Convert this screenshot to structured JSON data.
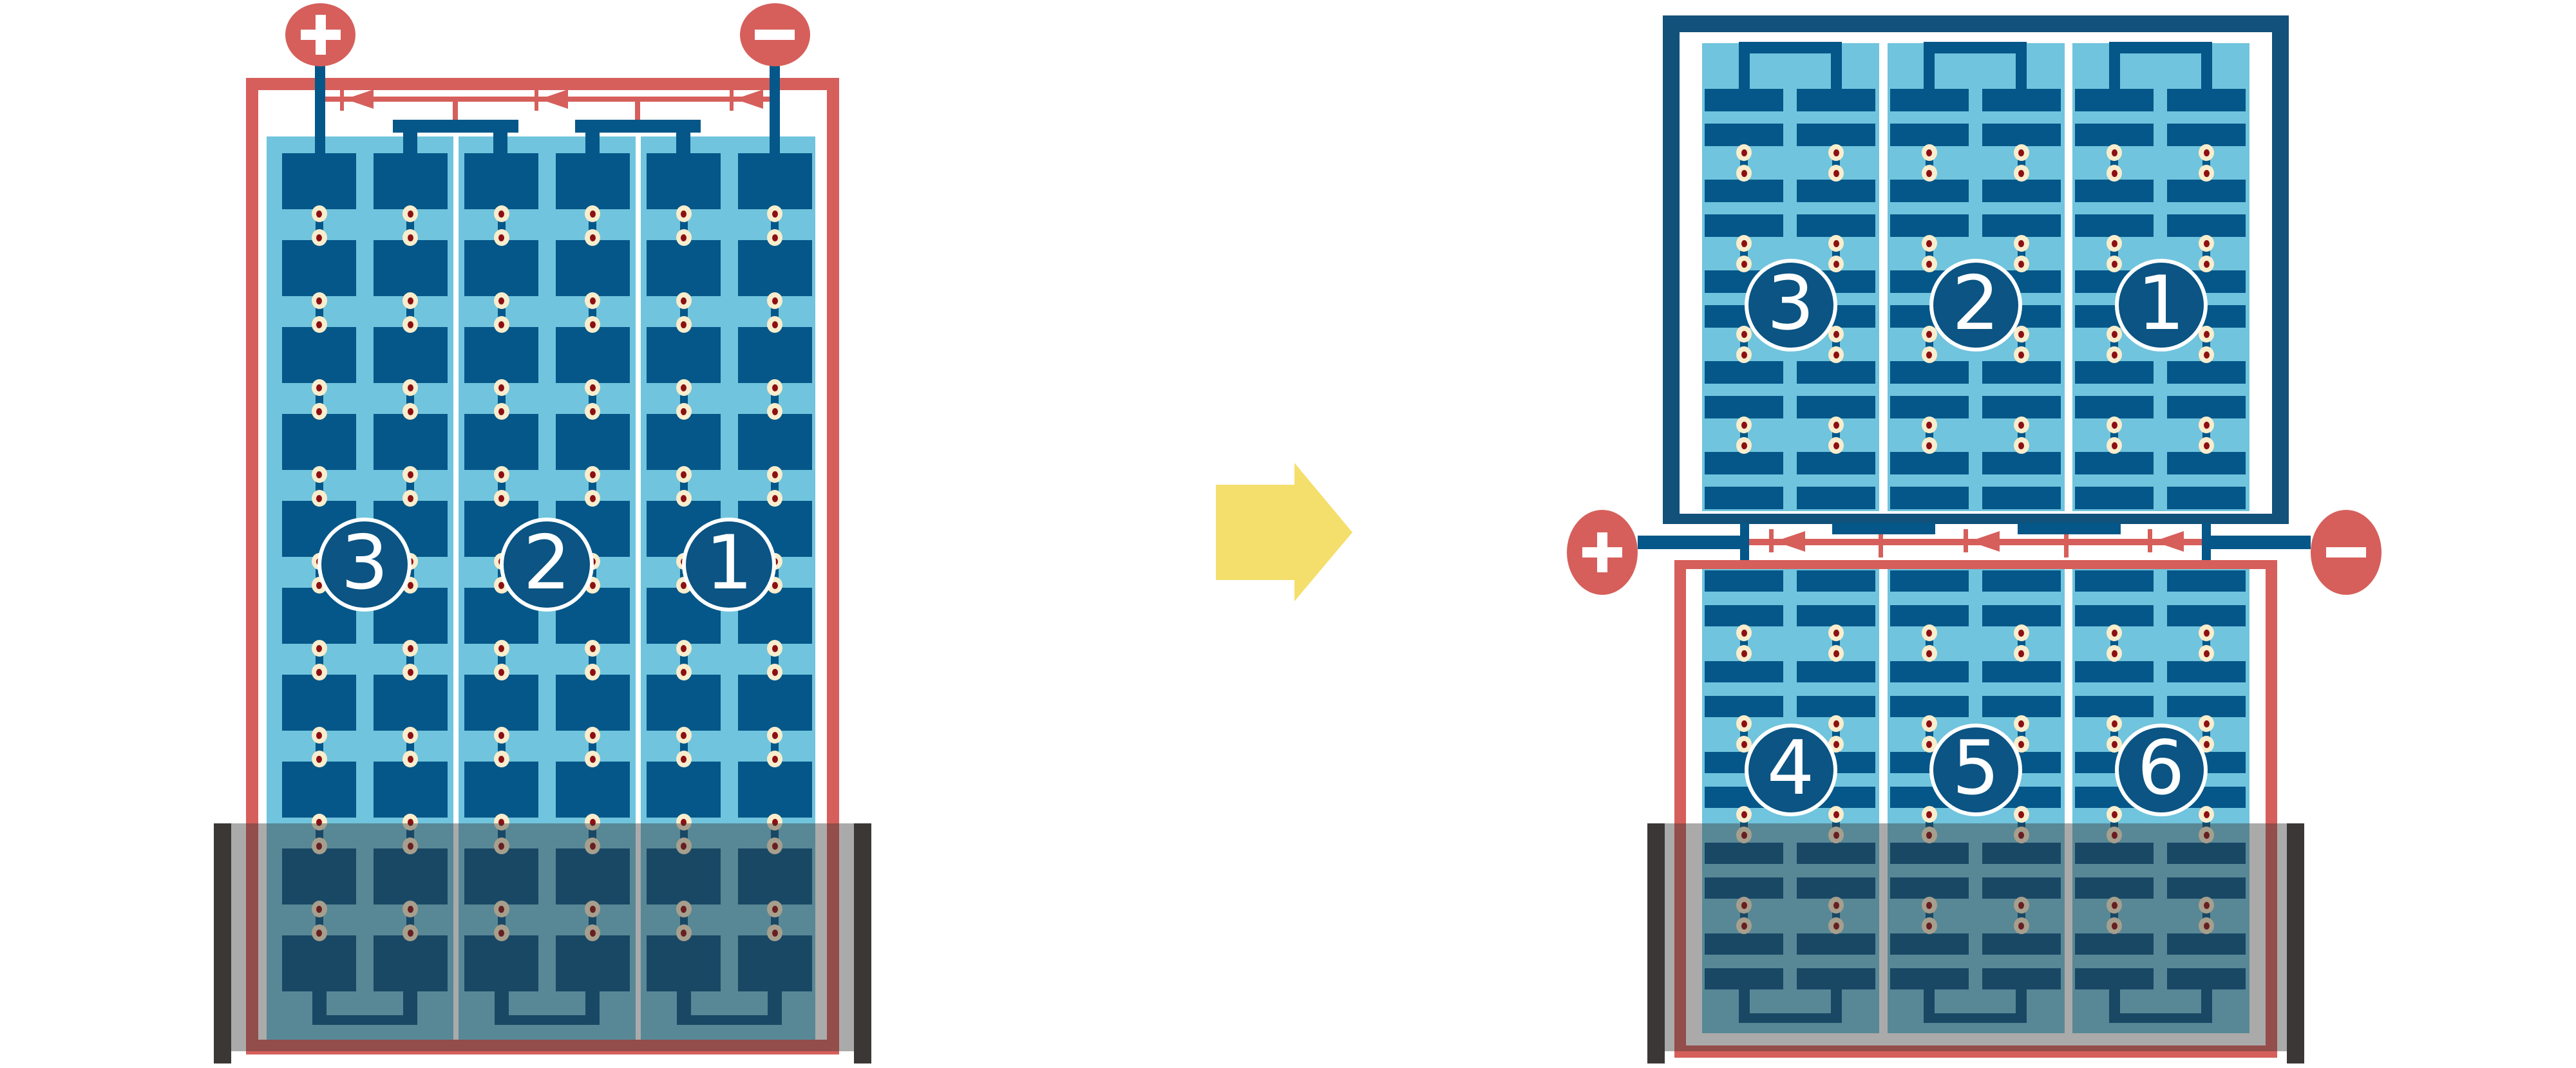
{
  "colors": {
    "red": "#D65F5B",
    "dark_blue": "#045788",
    "top_module_frame_blue": "#11517A",
    "light_blue_electrolyte": "#70C4DD",
    "connector_dot_cream": "#F8EDCD",
    "connector_dot_maroon": "#8C1013",
    "arrow_yellow": "#F4DF6C",
    "tray_gray": "#3A3736",
    "tray_overlay": "rgba(56,53,52,0.42)",
    "cell_circle_fill": "#0B5483",
    "white": "#FFFFFF"
  },
  "left_battery": {
    "plus_symbol": "+",
    "minus_symbol": "−",
    "cells": [
      {
        "label": "3"
      },
      {
        "label": "2"
      },
      {
        "label": "1"
      }
    ]
  },
  "right_battery": {
    "plus_symbol": "+",
    "minus_symbol": "−",
    "top_module_cells": [
      {
        "label": "3"
      },
      {
        "label": "2"
      },
      {
        "label": "1"
      }
    ],
    "bottom_module_cells": [
      {
        "label": "4"
      },
      {
        "label": "5"
      },
      {
        "label": "6"
      }
    ]
  },
  "icons": {
    "plus": "plus-icon",
    "minus": "minus-icon",
    "transform_arrow": "right-arrow-icon",
    "current_diodes": "left-diode-icon"
  }
}
